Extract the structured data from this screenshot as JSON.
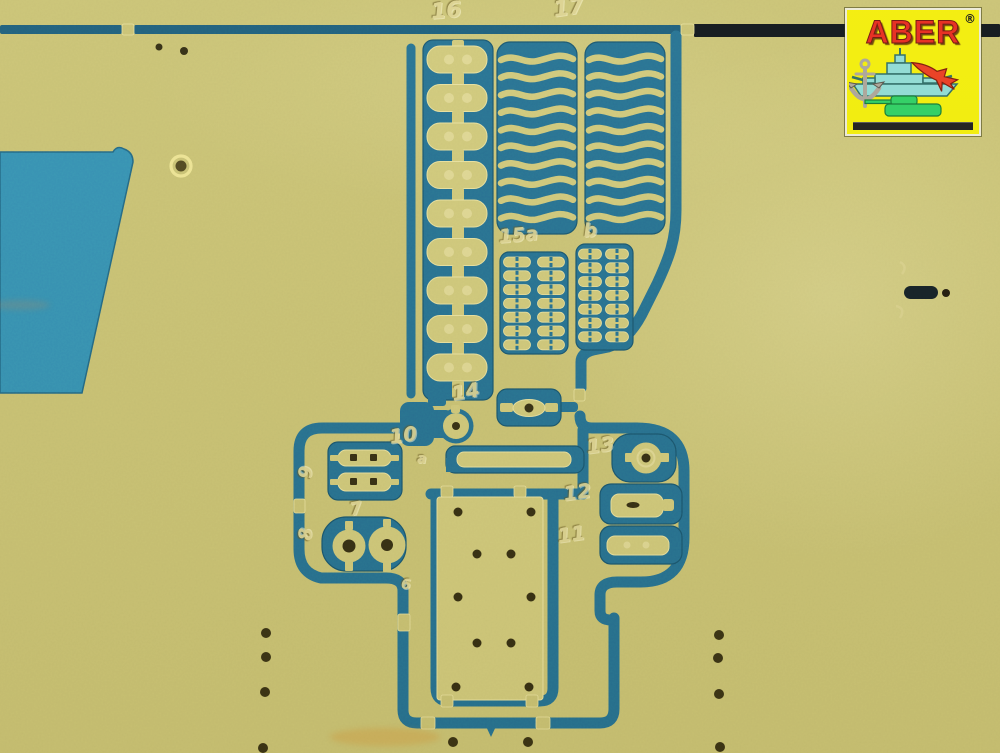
{
  "image": {
    "type": "photograph",
    "subject": "brass photo-etched model parts fret on teal backing",
    "width": 1000,
    "height": 753
  },
  "colors": {
    "brass": "#c6bf73",
    "brass_part": "#cdc67a",
    "brass_light": "#ddd593",
    "part_edge": "#e7df9e",
    "channel": "#1f6b92",
    "channel_dark": "#17587b",
    "channel_edge": "#12506f",
    "cutout_panel": "#2e8cb4",
    "top_rail_black": "#0b1118",
    "hole": "#2f2910",
    "etch": "#ddd494"
  },
  "logo": {
    "brand": "ABER",
    "registered": "®",
    "bg": "#f3ee08",
    "text_color": "#e6271c",
    "icons": [
      "warship-icon",
      "fighter-jet-icon",
      "tank-icon",
      "anchor-icon"
    ]
  },
  "etched_part_numbers": [
    {
      "text": "16",
      "x": 430,
      "y": 2,
      "size": 22,
      "rot": -5
    },
    {
      "text": "17",
      "x": 552,
      "y": 0,
      "size": 22,
      "rot": -8
    },
    {
      "text": "15a",
      "x": 498,
      "y": 228,
      "size": 19,
      "rot": -5
    },
    {
      "text": "b",
      "x": 583,
      "y": 222,
      "size": 19,
      "rot": -3
    },
    {
      "text": "14",
      "x": 450,
      "y": 384,
      "size": 20,
      "rot": -10
    },
    {
      "text": "10",
      "x": 388,
      "y": 427,
      "size": 20,
      "rot": -8
    },
    {
      "text": "a",
      "x": 417,
      "y": 452,
      "size": 14,
      "rot": 0
    },
    {
      "text": "13",
      "x": 585,
      "y": 437,
      "size": 20,
      "rot": -8
    },
    {
      "text": "12",
      "x": 562,
      "y": 484,
      "size": 20,
      "rot": -8
    },
    {
      "text": "11",
      "x": 556,
      "y": 526,
      "size": 20,
      "rot": -8
    },
    {
      "text": "9",
      "x": 297,
      "y": 478,
      "size": 18,
      "rot": -86
    },
    {
      "text": "7",
      "x": 348,
      "y": 502,
      "size": 18,
      "rot": -12
    },
    {
      "text": "8",
      "x": 297,
      "y": 540,
      "size": 18,
      "rot": -86
    },
    {
      "text": "6",
      "x": 401,
      "y": 578,
      "size": 14,
      "rot": 0
    }
  ],
  "fret": {
    "ladder_part_16": {
      "links": 9
    },
    "spring_strips_part_17": {
      "columns": 2,
      "strips_per_column": 10
    },
    "clamp_grid_part_15a": {
      "rows": 7,
      "cols": 2
    },
    "clamp_grid_part_b": {
      "rows": 7,
      "cols": 2
    },
    "plate_part_6_holes": [
      [
        458,
        512
      ],
      [
        531,
        512
      ],
      [
        477,
        554
      ],
      [
        511,
        554
      ],
      [
        458,
        597
      ],
      [
        531,
        597
      ],
      [
        477,
        643
      ],
      [
        511,
        643
      ],
      [
        456,
        687
      ],
      [
        529,
        687
      ]
    ],
    "sprue_dots": [
      [
        266,
        633
      ],
      [
        266,
        657
      ],
      [
        265,
        692
      ],
      [
        263,
        748
      ],
      [
        719,
        635
      ],
      [
        718,
        658
      ],
      [
        719,
        694
      ],
      [
        720,
        747
      ],
      [
        453,
        742
      ],
      [
        528,
        742
      ]
    ],
    "small_holes": [
      [
        159,
        47
      ],
      [
        184,
        51
      ]
    ],
    "slot_hole": [
      921,
      293
    ],
    "ring_eyelet": [
      181,
      166
    ]
  }
}
